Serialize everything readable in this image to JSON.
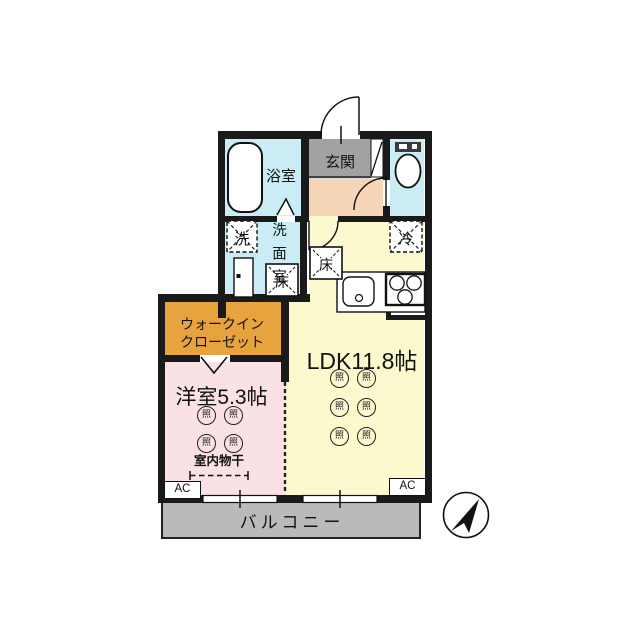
{
  "plan": {
    "rooms": {
      "entrance": "玄関",
      "bathroom": "浴室",
      "washroom": "洗面室",
      "ldk": "LDK11.8帖",
      "walk_in_closet_line1": "ウォークイン",
      "walk_in_closet_line2": "クローゼット",
      "western_room": "洋室5.3帖",
      "balcony": "バルコニー"
    },
    "labels": {
      "washer": "洗",
      "refrigerator": "冷",
      "floor_storage": "床",
      "ceiling_light": "照",
      "indoor_drying": "室内物干",
      "air_conditioner": "AC"
    },
    "colors": {
      "ldk": "#fcf9cf",
      "western_room": "#f9e1e5",
      "walk_in_closet": "#e7a33e",
      "wet_area": "#c9ecf5",
      "hallway": "#f6d6b6",
      "entrance": "#a2a2a4",
      "balcony": "#bababa",
      "wall": "#1a1a1a"
    }
  }
}
